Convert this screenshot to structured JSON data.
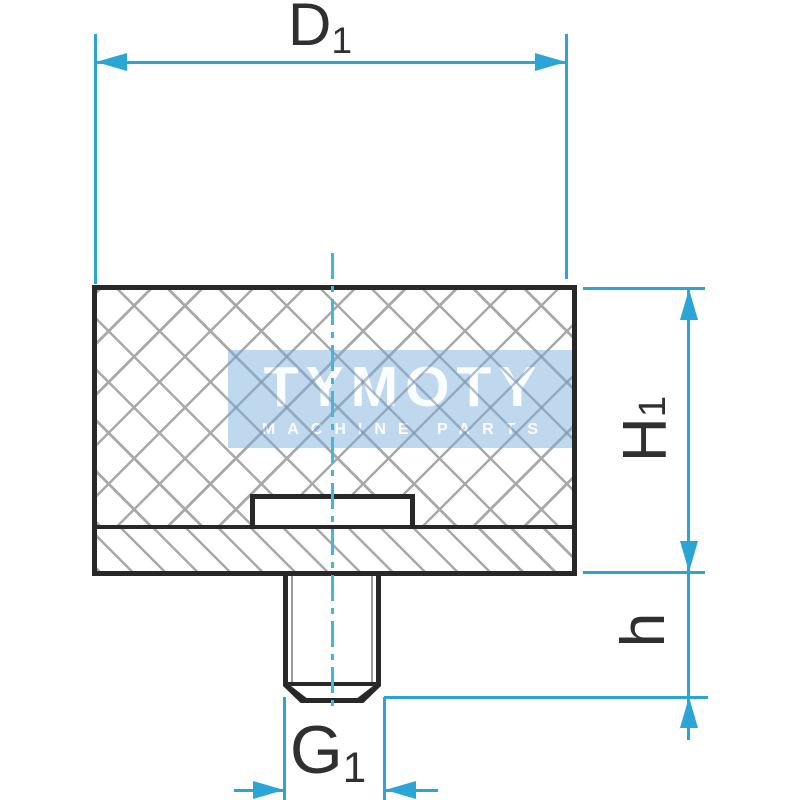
{
  "dimensions": {
    "d1": {
      "main": "D",
      "sub": "1"
    },
    "h1": {
      "main": "H",
      "sub": "1"
    },
    "h": {
      "main": "h",
      "sub": ""
    },
    "g1": {
      "main": "G",
      "sub": "1"
    }
  },
  "watermark": {
    "brand": "TYMOTY",
    "tagline": "MACHINE PARTS"
  },
  "colors": {
    "dimension_blue": "#2aa5d6",
    "centerline_blue": "#44b5dc",
    "line_black": "#282828",
    "hatch_gray": "#a9a9a9",
    "label_gray": "#303030",
    "watermark_bg": "#b2d0e9",
    "watermark_text": "#ffffff"
  }
}
